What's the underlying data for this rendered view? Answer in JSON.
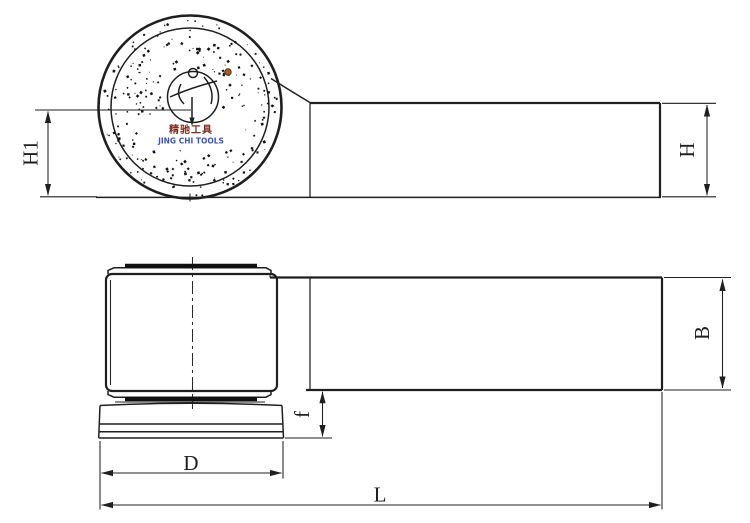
{
  "colors": {
    "line": "#1f1f1f",
    "brand_chinese": "#7b2d20",
    "brand_english": "#3c55b8",
    "knurl_dot_accent": "#a85c28"
  },
  "brand": {
    "chinese": "精驰工具",
    "english": "JING CHI TOOLS"
  },
  "dimensions": {
    "h1": "H1",
    "h": "H",
    "b": "B",
    "f": "f",
    "d": "D",
    "l": "L"
  }
}
